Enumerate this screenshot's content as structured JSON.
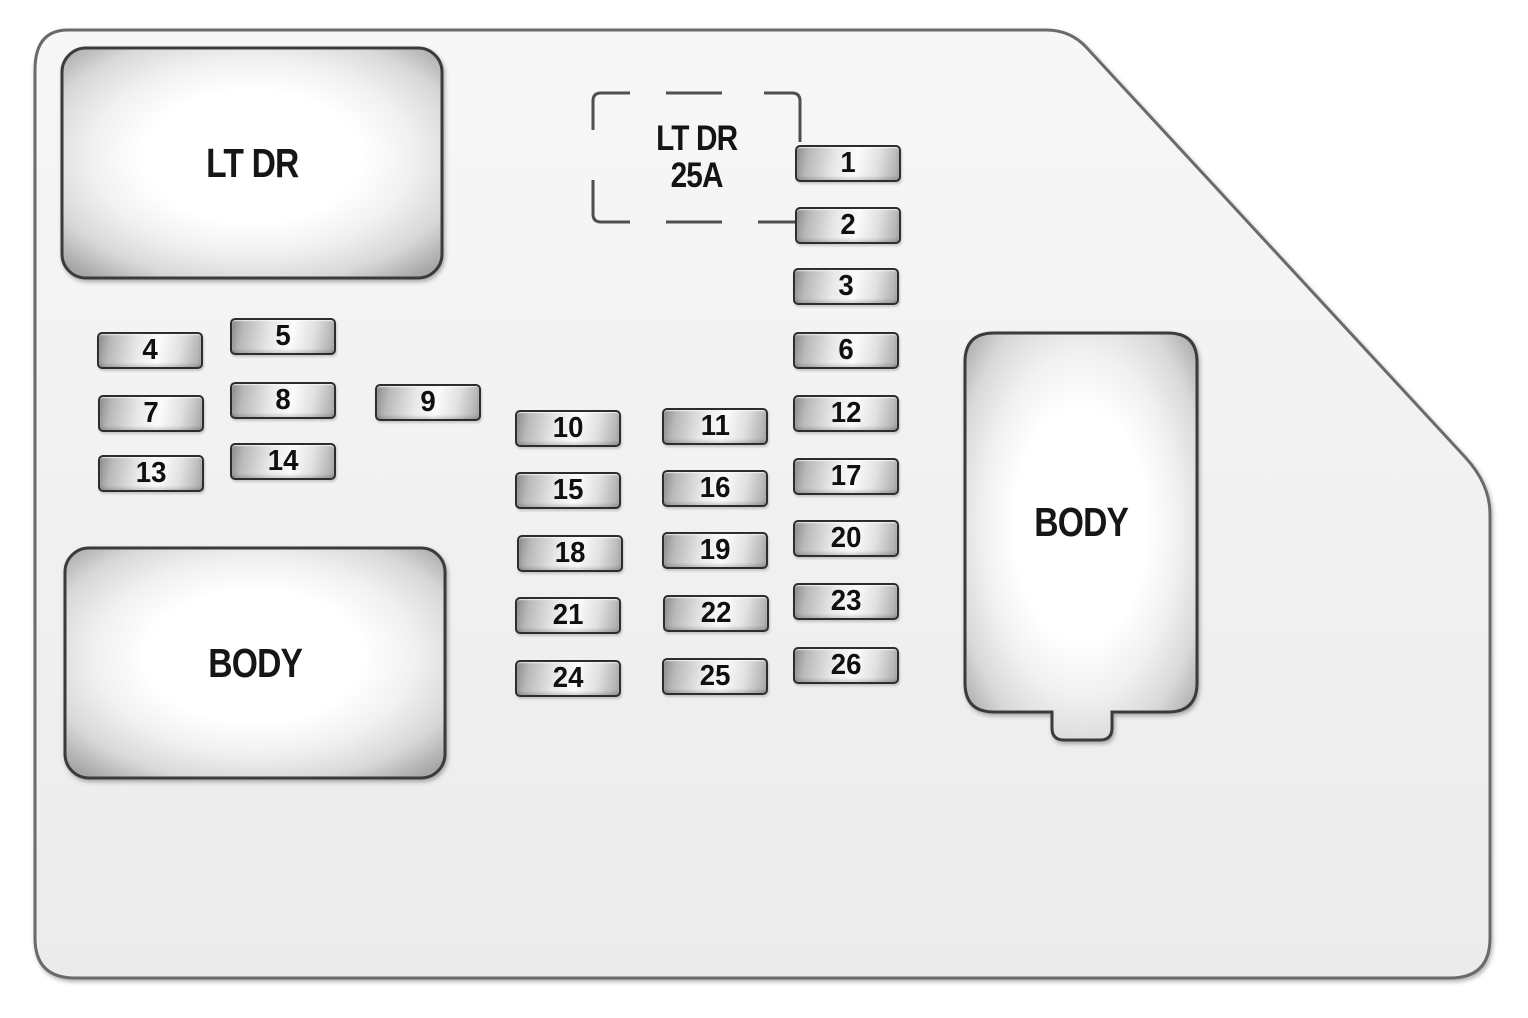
{
  "diagram": {
    "panel_fill": "#f2f2f2",
    "panel_outline": "#6a6a6a",
    "fuse_outline": "#2d2d2d",
    "block_outline": "#3a3a3a",
    "dash_color": "#4f4f4f"
  },
  "blocks": {
    "lt_dr": {
      "label": "LT DR"
    },
    "body_bottom": {
      "label": "BODY"
    },
    "body_right": {
      "label": "BODY"
    }
  },
  "dashed_fuse": {
    "line1": "LT DR",
    "line2": "25A"
  },
  "fuses": [
    {
      "n": "1",
      "x": 795,
      "y": 145
    },
    {
      "n": "2",
      "x": 795,
      "y": 207
    },
    {
      "n": "3",
      "x": 793,
      "y": 268
    },
    {
      "n": "4",
      "x": 97,
      "y": 332
    },
    {
      "n": "5",
      "x": 230,
      "y": 318
    },
    {
      "n": "6",
      "x": 793,
      "y": 332
    },
    {
      "n": "7",
      "x": 98,
      "y": 395
    },
    {
      "n": "8",
      "x": 230,
      "y": 382
    },
    {
      "n": "9",
      "x": 375,
      "y": 384
    },
    {
      "n": "10",
      "x": 515,
      "y": 410
    },
    {
      "n": "11",
      "x": 662,
      "y": 408
    },
    {
      "n": "12",
      "x": 793,
      "y": 395
    },
    {
      "n": "13",
      "x": 98,
      "y": 455
    },
    {
      "n": "14",
      "x": 230,
      "y": 443
    },
    {
      "n": "15",
      "x": 515,
      "y": 472
    },
    {
      "n": "16",
      "x": 662,
      "y": 470
    },
    {
      "n": "17",
      "x": 793,
      "y": 458
    },
    {
      "n": "18",
      "x": 517,
      "y": 535
    },
    {
      "n": "19",
      "x": 662,
      "y": 532
    },
    {
      "n": "20",
      "x": 793,
      "y": 520
    },
    {
      "n": "21",
      "x": 515,
      "y": 597
    },
    {
      "n": "22",
      "x": 663,
      "y": 595
    },
    {
      "n": "23",
      "x": 793,
      "y": 583
    },
    {
      "n": "24",
      "x": 515,
      "y": 660
    },
    {
      "n": "25",
      "x": 662,
      "y": 658
    },
    {
      "n": "26",
      "x": 793,
      "y": 647
    }
  ]
}
